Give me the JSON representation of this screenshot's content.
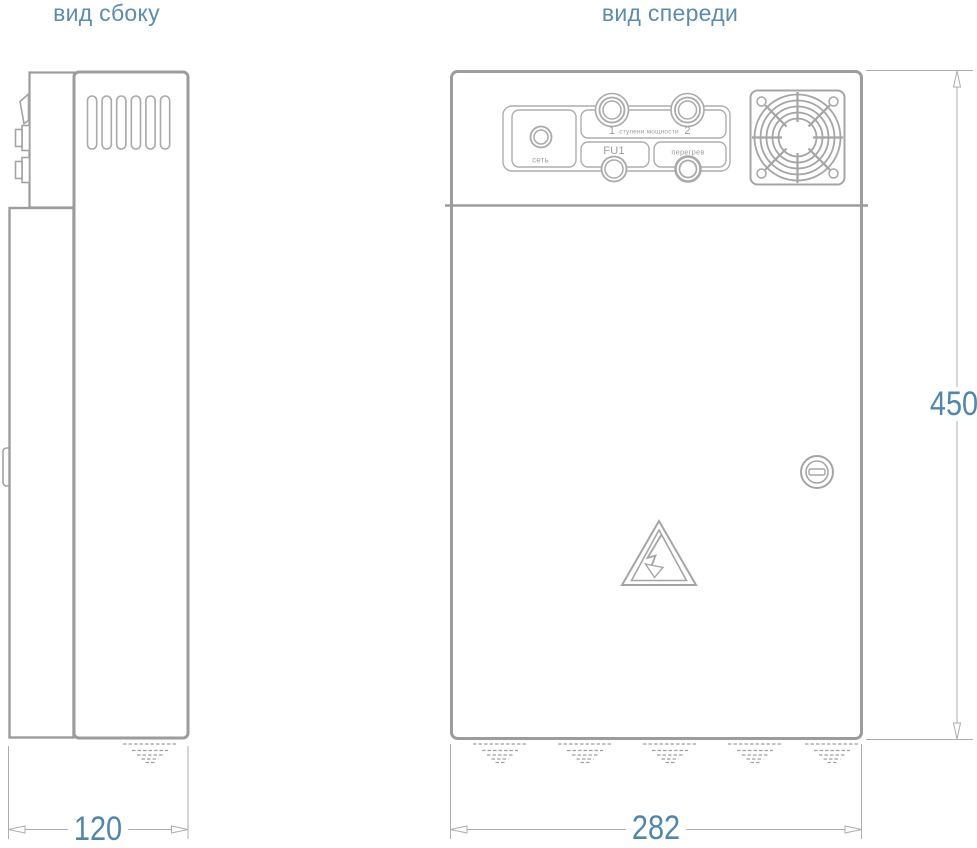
{
  "titles": {
    "side": "вид сбоку",
    "front": "вид спереди"
  },
  "front_panel": {
    "power_lamp_label": "сеть",
    "stage_1_label": "1",
    "stages_label": "ступени мощности",
    "stage_2_label": "2",
    "fuse_label": "FU1",
    "overheat_label": "перегрев"
  },
  "dimensions": {
    "side_width_mm": "120",
    "front_width_mm": "282",
    "height_mm": "450"
  },
  "colors": {
    "accent_blue": "#4f86ad",
    "title_blue": "#5b8cb0",
    "outline_gray": "#9c9c9c",
    "detail_gray": "#a9a9a9",
    "background": "#ffffff"
  },
  "icons": {
    "fan": "fan-grille-icon",
    "lock": "lock-icon",
    "warning": "high-voltage-warning-icon",
    "ground": "ground-hatch-icon"
  }
}
